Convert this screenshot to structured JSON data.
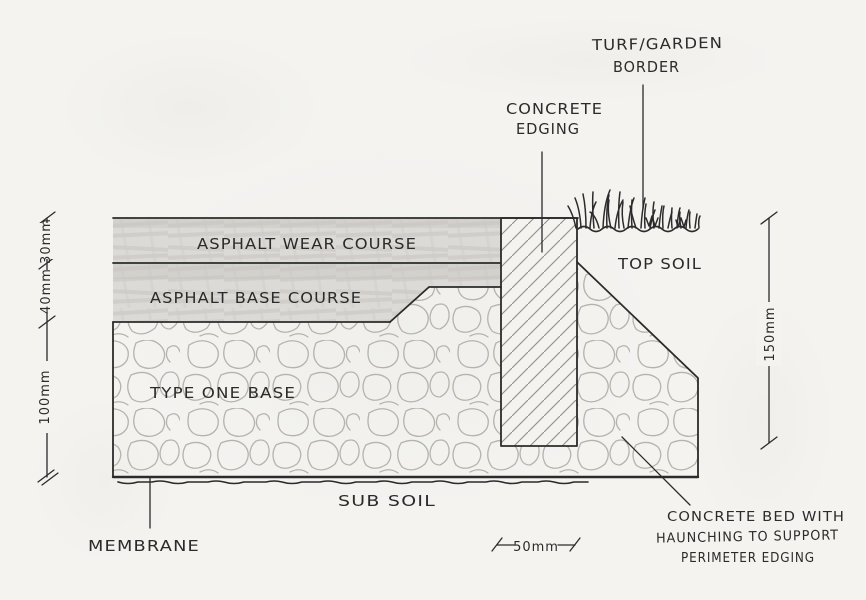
{
  "colors": {
    "paper": "#f4f3f0",
    "ink": "#2b2b2b",
    "pencil": "#b4b1ab",
    "graphite": "#dcdad6"
  },
  "drawing": {
    "labels": {
      "turf_garden_border_line1": "TURF/GARDEN",
      "turf_garden_border_line2": "BORDER",
      "concrete_edging_line1": "CONCRETE",
      "concrete_edging_line2": "EDGING",
      "asphalt_wear_course": "ASPHALT WEAR COURSE",
      "asphalt_base_course": "ASPHALT BASE COURSE",
      "type_one_base": "TYPE ONE BASE",
      "top_soil": "TOP SOIL",
      "sub_soil": "SUB SOIL",
      "membrane": "MEMBRANE",
      "concrete_bed_line1": "CONCRETE BED WITH",
      "concrete_bed_line2": "HAUNCHING TO SUPPORT",
      "concrete_bed_line3": "PERIMETER EDGING"
    },
    "dimensions": {
      "wear_course_thickness": "30mm",
      "base_course_thickness": "40mm",
      "type_one_thickness": "100mm",
      "edging_depth": "150mm",
      "edging_width": "50mm"
    }
  }
}
